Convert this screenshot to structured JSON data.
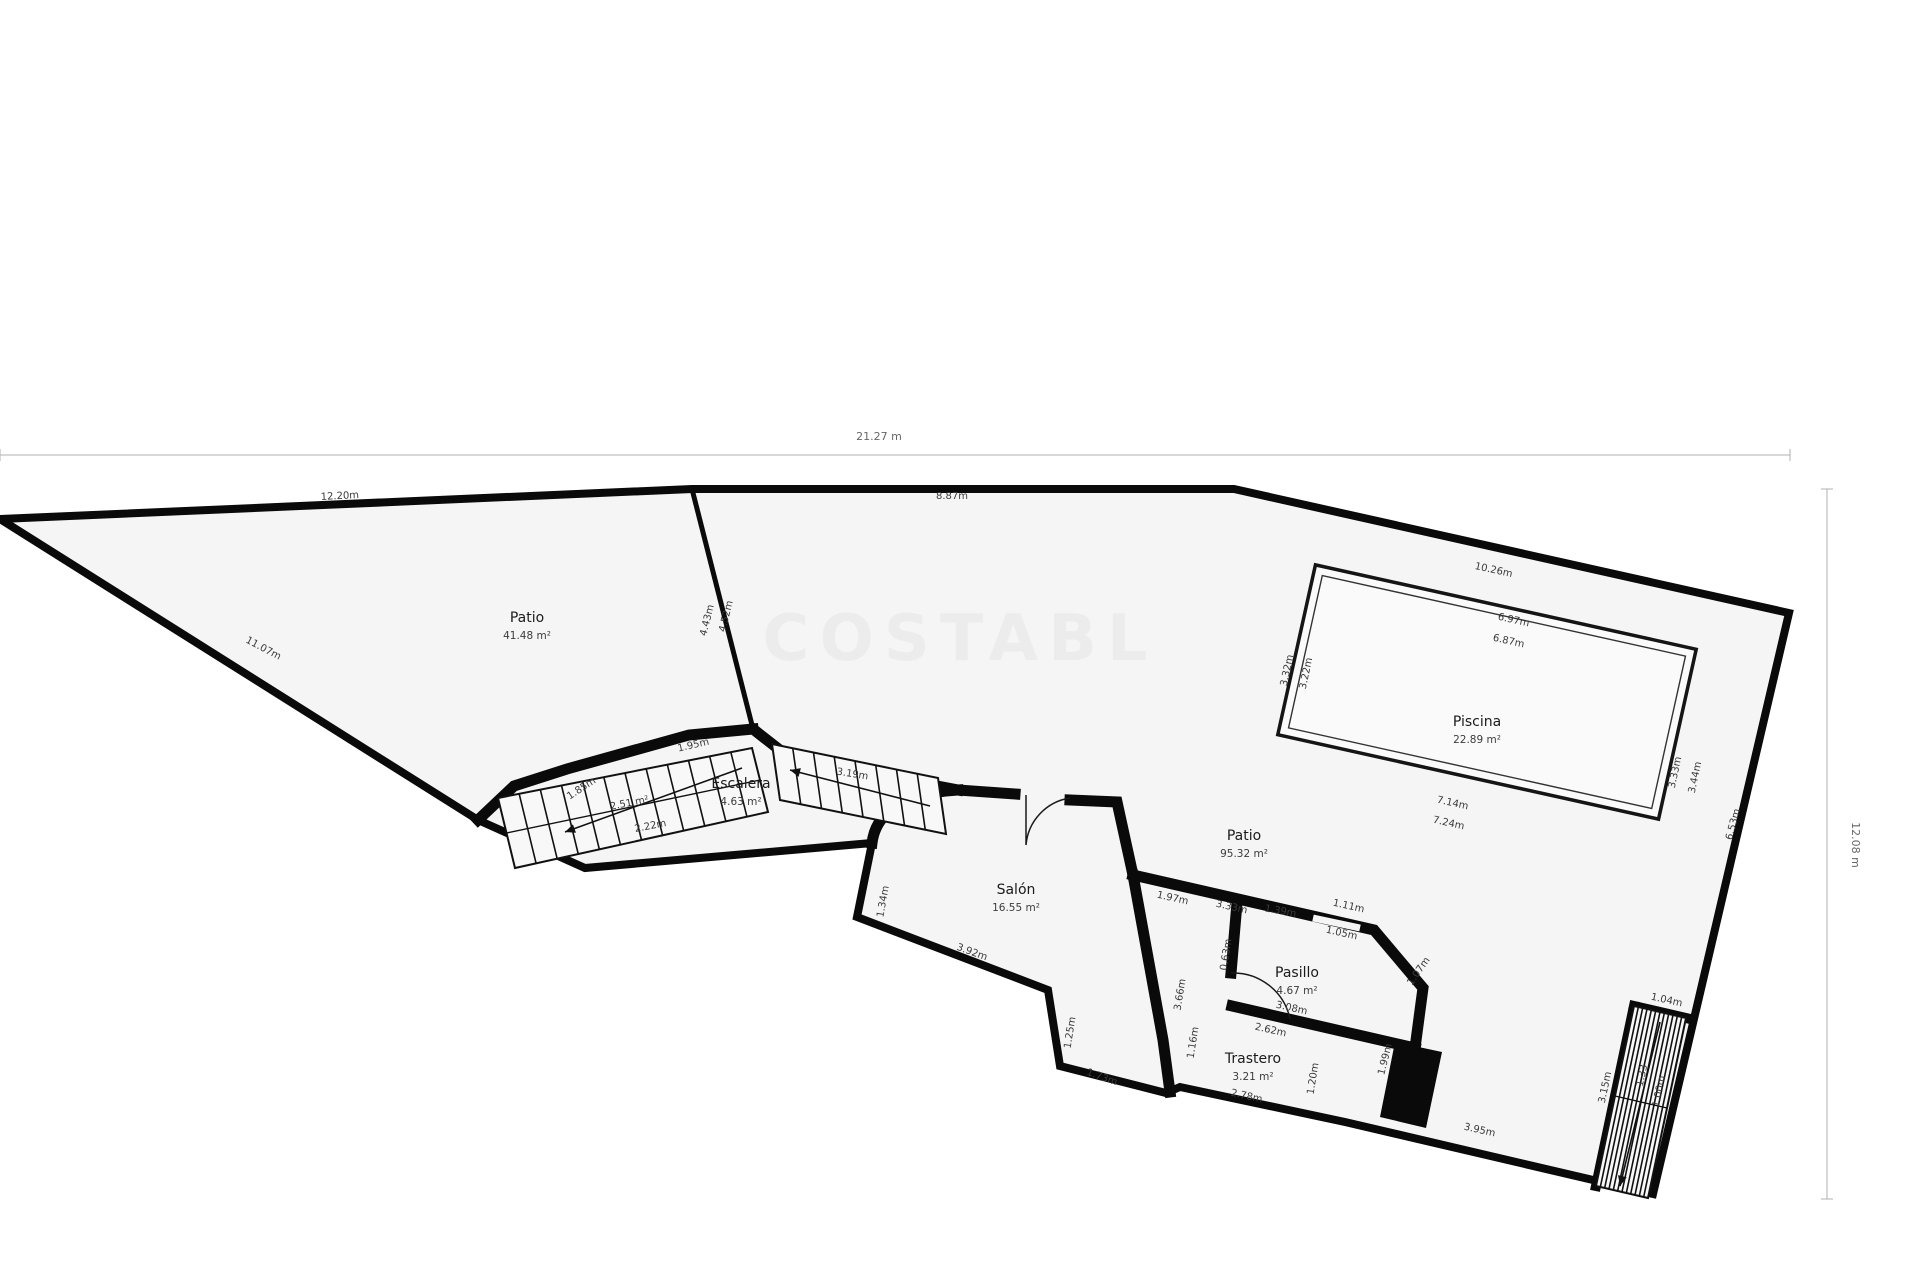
{
  "watermark": "COSTABL",
  "overall": {
    "width_label": "21.27 m",
    "height_label": "12.08 m"
  },
  "style": {
    "wall_color": "#0a0a0a",
    "plot_fill": "#f5f5f5",
    "pool_fill": "#fafafa",
    "dim_text_color": "#3a3a3a"
  },
  "rooms": [
    {
      "name": "Patio",
      "area": "41.48 m²",
      "x": 527,
      "y": 622
    },
    {
      "name": "Escalera",
      "area": "4.63 m²",
      "x": 741,
      "y": 788
    },
    {
      "name": "Piscina",
      "area": "22.89 m²",
      "x": 1477,
      "y": 726
    },
    {
      "name": "Patio",
      "area": "95.32 m²",
      "x": 1244,
      "y": 840
    },
    {
      "name": "Salón",
      "area": "16.55 m²",
      "x": 1016,
      "y": 894
    },
    {
      "name": "Pasillo",
      "area": "4.67 m²",
      "x": 1297,
      "y": 977
    },
    {
      "name": "Trastero",
      "area": "3.21 m²",
      "x": 1253,
      "y": 1063
    }
  ],
  "dimensions": [
    {
      "text": "12.20m",
      "x": 340,
      "y": 499,
      "r": -3
    },
    {
      "text": "8.87m",
      "x": 952,
      "y": 499,
      "r": 0
    },
    {
      "text": "10.26m",
      "x": 1493,
      "y": 573,
      "r": 12.5
    },
    {
      "text": "11.07m",
      "x": 262,
      "y": 651,
      "r": 28
    },
    {
      "text": "4.43m",
      "x": 710,
      "y": 621,
      "r": -76
    },
    {
      "text": "4.52m",
      "x": 729,
      "y": 617,
      "r": -76
    },
    {
      "text": "6.97m",
      "x": 1513,
      "y": 623,
      "r": 12.5
    },
    {
      "text": "6.87m",
      "x": 1508,
      "y": 644,
      "r": 12.5
    },
    {
      "text": "3.32m",
      "x": 1290,
      "y": 671,
      "r": -78
    },
    {
      "text": "3.22m",
      "x": 1309,
      "y": 674,
      "r": -78
    },
    {
      "text": "3.33m",
      "x": 1678,
      "y": 773,
      "r": -78
    },
    {
      "text": "3.44m",
      "x": 1698,
      "y": 778,
      "r": -78
    },
    {
      "text": "7.14m",
      "x": 1452,
      "y": 806,
      "r": 12.5
    },
    {
      "text": "7.24m",
      "x": 1448,
      "y": 826,
      "r": 12.5
    },
    {
      "text": "6.53m",
      "x": 1736,
      "y": 825,
      "r": -75
    },
    {
      "text": "1.95m",
      "x": 694,
      "y": 748,
      "r": -13
    },
    {
      "text": "1.85m",
      "x": 583,
      "y": 791,
      "r": -33
    },
    {
      "text": "3.19m",
      "x": 852,
      "y": 777,
      "r": 9
    },
    {
      "text": "2.51 m²",
      "x": 630,
      "y": 806,
      "r": -11
    },
    {
      "text": "2.22m",
      "x": 651,
      "y": 829,
      "r": -11
    },
    {
      "text": "1.34m",
      "x": 886,
      "y": 902,
      "r": -80
    },
    {
      "text": "3.92m",
      "x": 971,
      "y": 955,
      "r": 20
    },
    {
      "text": "1.97m",
      "x": 1172,
      "y": 901,
      "r": 12.5
    },
    {
      "text": "3.33m",
      "x": 1231,
      "y": 910,
      "r": 12.5
    },
    {
      "text": "1.39m",
      "x": 1280,
      "y": 914,
      "r": 10
    },
    {
      "text": "1.11m",
      "x": 1348,
      "y": 909,
      "r": 12.5
    },
    {
      "text": "1.05m",
      "x": 1341,
      "y": 936,
      "r": 12.5
    },
    {
      "text": "0.63m",
      "x": 1229,
      "y": 955,
      "r": -81
    },
    {
      "text": "1.07m",
      "x": 1421,
      "y": 973,
      "r": -55
    },
    {
      "text": "3.08m",
      "x": 1291,
      "y": 1011,
      "r": 12.5
    },
    {
      "text": "2.62m",
      "x": 1270,
      "y": 1033,
      "r": 12.5
    },
    {
      "text": "3.66m",
      "x": 1183,
      "y": 995,
      "r": -81
    },
    {
      "text": "1.16m",
      "x": 1196,
      "y": 1043,
      "r": -81
    },
    {
      "text": "1.25m",
      "x": 1073,
      "y": 1033,
      "r": -81
    },
    {
      "text": "1.73m",
      "x": 1101,
      "y": 1080,
      "r": 20
    },
    {
      "text": "2.78m",
      "x": 1246,
      "y": 1099,
      "r": 12.5
    },
    {
      "text": "1.20m",
      "x": 1316,
      "y": 1079,
      "r": -81
    },
    {
      "text": "1.99m",
      "x": 1388,
      "y": 1060,
      "r": -76
    },
    {
      "text": "3.95m",
      "x": 1479,
      "y": 1133,
      "r": 12.5
    },
    {
      "text": "3.15m",
      "x": 1608,
      "y": 1088,
      "r": -78
    },
    {
      "text": "1.04m",
      "x": 1666,
      "y": 1003,
      "r": 12.5
    },
    {
      "text": "1.33",
      "x": 1645,
      "y": 1076,
      "r": -78
    },
    {
      "text": "1.00m",
      "x": 1662,
      "y": 1092,
      "r": -78
    }
  ]
}
